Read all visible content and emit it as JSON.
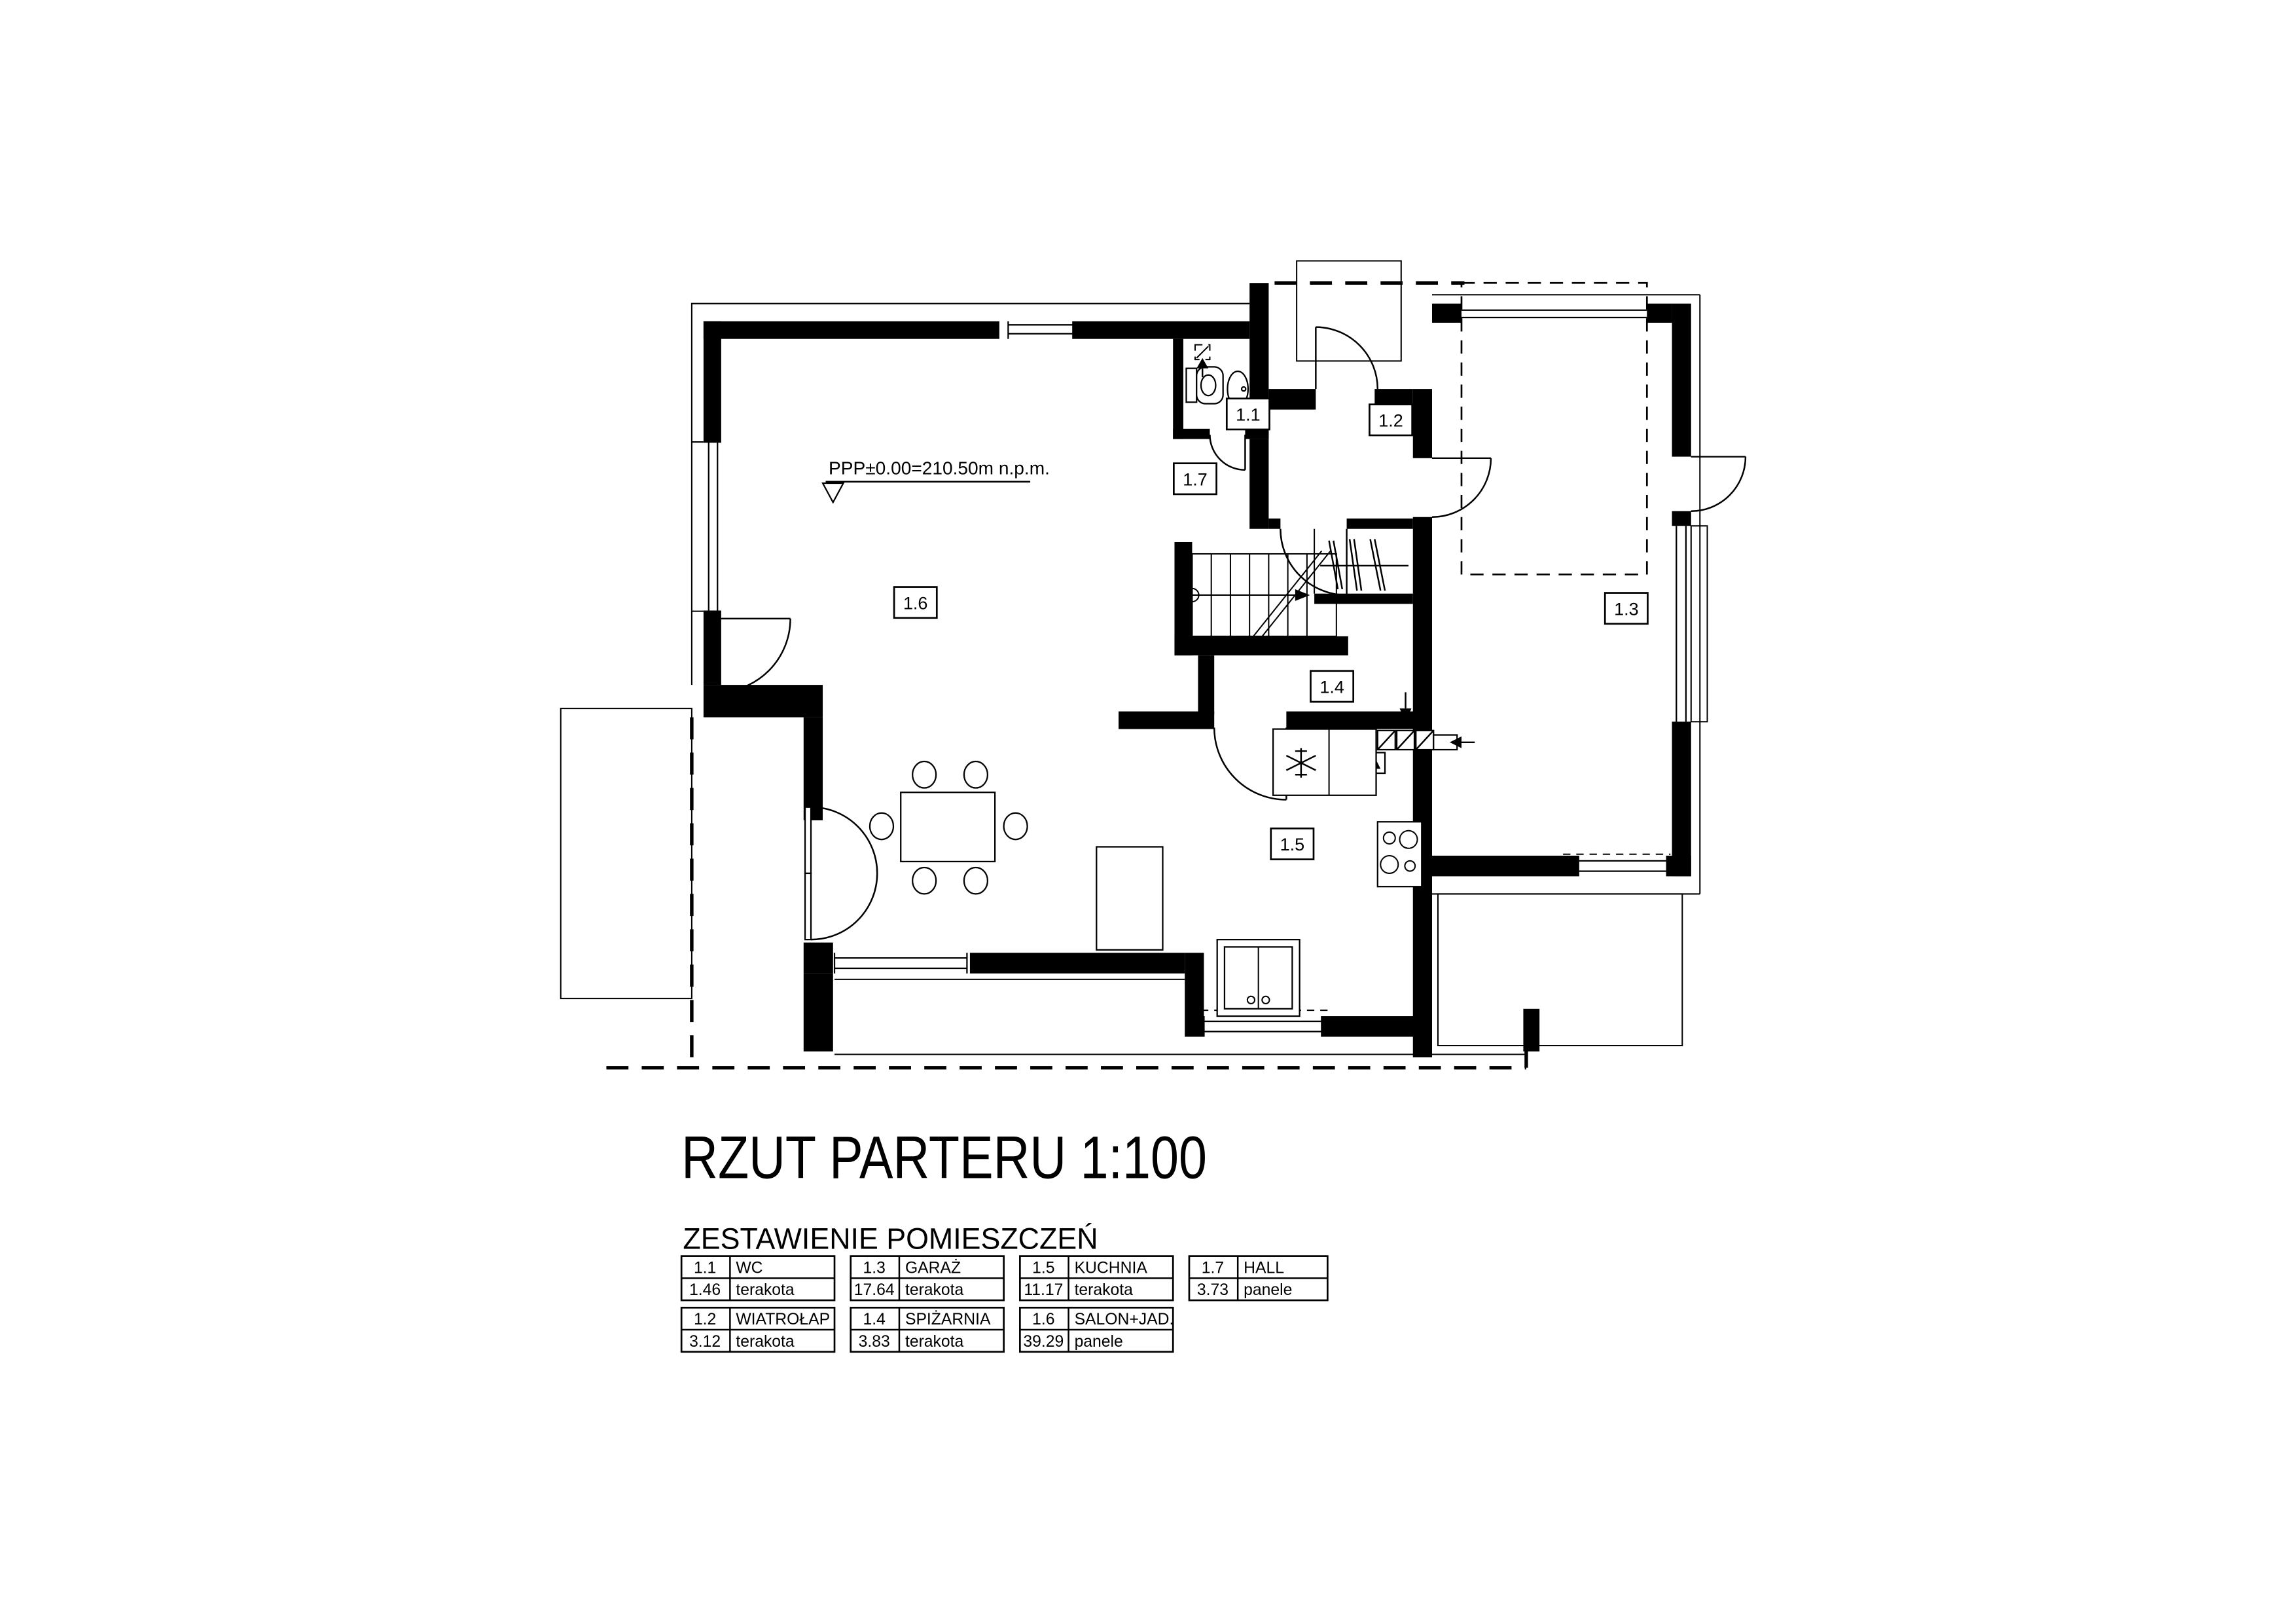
{
  "title": "RZUT PARTERU 1:100",
  "subtitle": "ZESTAWIENIE POMIESZCZEŃ",
  "plan": {
    "level_annotation": "PPP±0.00=210.50m  n.p.m.",
    "rooms": [
      {
        "id": "1.1",
        "name": "WC"
      },
      {
        "id": "1.2",
        "name": "WIATROŁAP"
      },
      {
        "id": "1.3",
        "name": "GARAŻ"
      },
      {
        "id": "1.4",
        "name": "SPIŻARNIA"
      },
      {
        "id": "1.5",
        "name": "KUCHNIA"
      },
      {
        "id": "1.6",
        "name": "SALON+JAD."
      },
      {
        "id": "1.7",
        "name": "HALL"
      }
    ]
  },
  "legend": {
    "entries": [
      {
        "code": "1.1",
        "name": "WC",
        "area": "1.46",
        "floor": "terakota"
      },
      {
        "code": "1.3",
        "name": "GARAŻ",
        "area": "17.64",
        "floor": "terakota"
      },
      {
        "code": "1.5",
        "name": "KUCHNIA",
        "area": "11.17",
        "floor": "terakota"
      },
      {
        "code": "1.7",
        "name": "HALL",
        "area": "3.73",
        "floor": "panele"
      },
      {
        "code": "1.2",
        "name": "WIATROŁAP",
        "area": "3.12",
        "floor": "terakota"
      },
      {
        "code": "1.4",
        "name": "SPIŻARNIA",
        "area": "3.83",
        "floor": "terakota"
      },
      {
        "code": "1.6",
        "name": "SALON+JAD.",
        "area": "39.29",
        "floor": "panele"
      }
    ]
  },
  "colors": {
    "ink": "#000000",
    "paper": "#ffffff"
  }
}
